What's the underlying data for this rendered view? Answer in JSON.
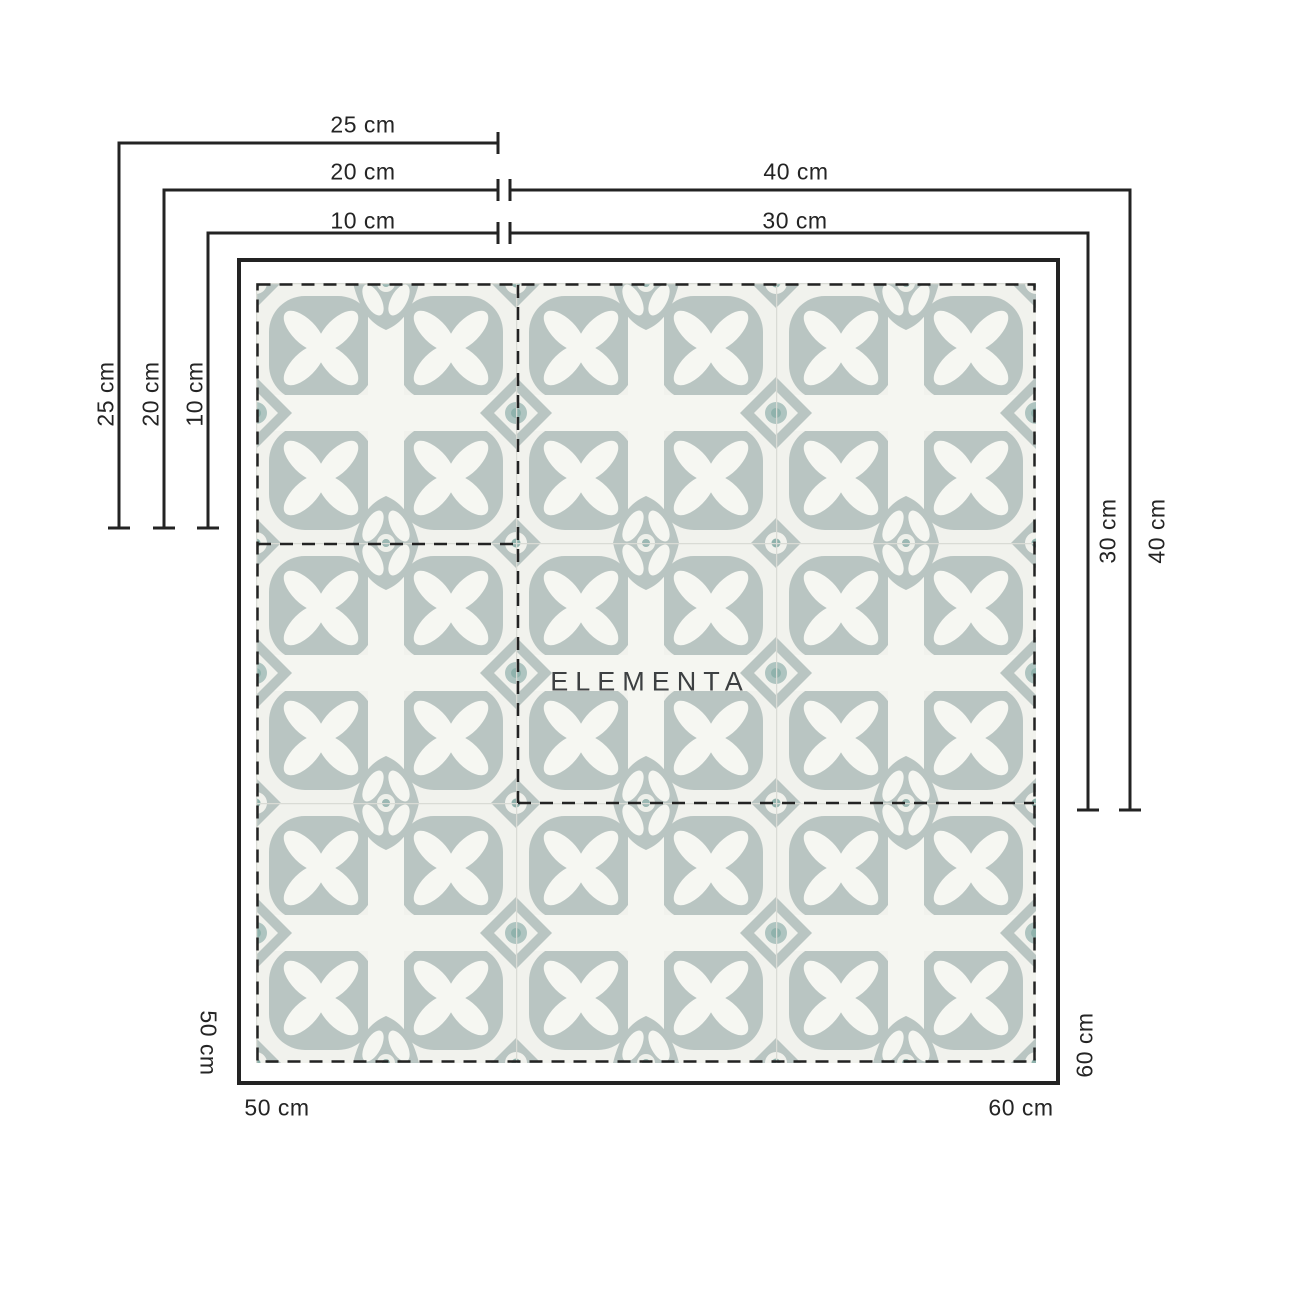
{
  "brand": {
    "watermark": "ELEMENTA"
  },
  "sizes": {
    "s10": "10 cm",
    "s20": "20 cm",
    "s25": "25 cm",
    "s30": "30 cm",
    "s40": "40 cm",
    "s50": "50 cm",
    "s60": "60 cm"
  },
  "colors": {
    "line": "#232323",
    "label_text": "#242424",
    "watermark_text": "#3d4042",
    "pattern_main": "#b9c5c2",
    "pattern_background": "#f1f2ed",
    "pattern_cream": "#f5f6f1",
    "pattern_teal_accent": "#8fb2ac",
    "grout": "#d9dbd5"
  }
}
